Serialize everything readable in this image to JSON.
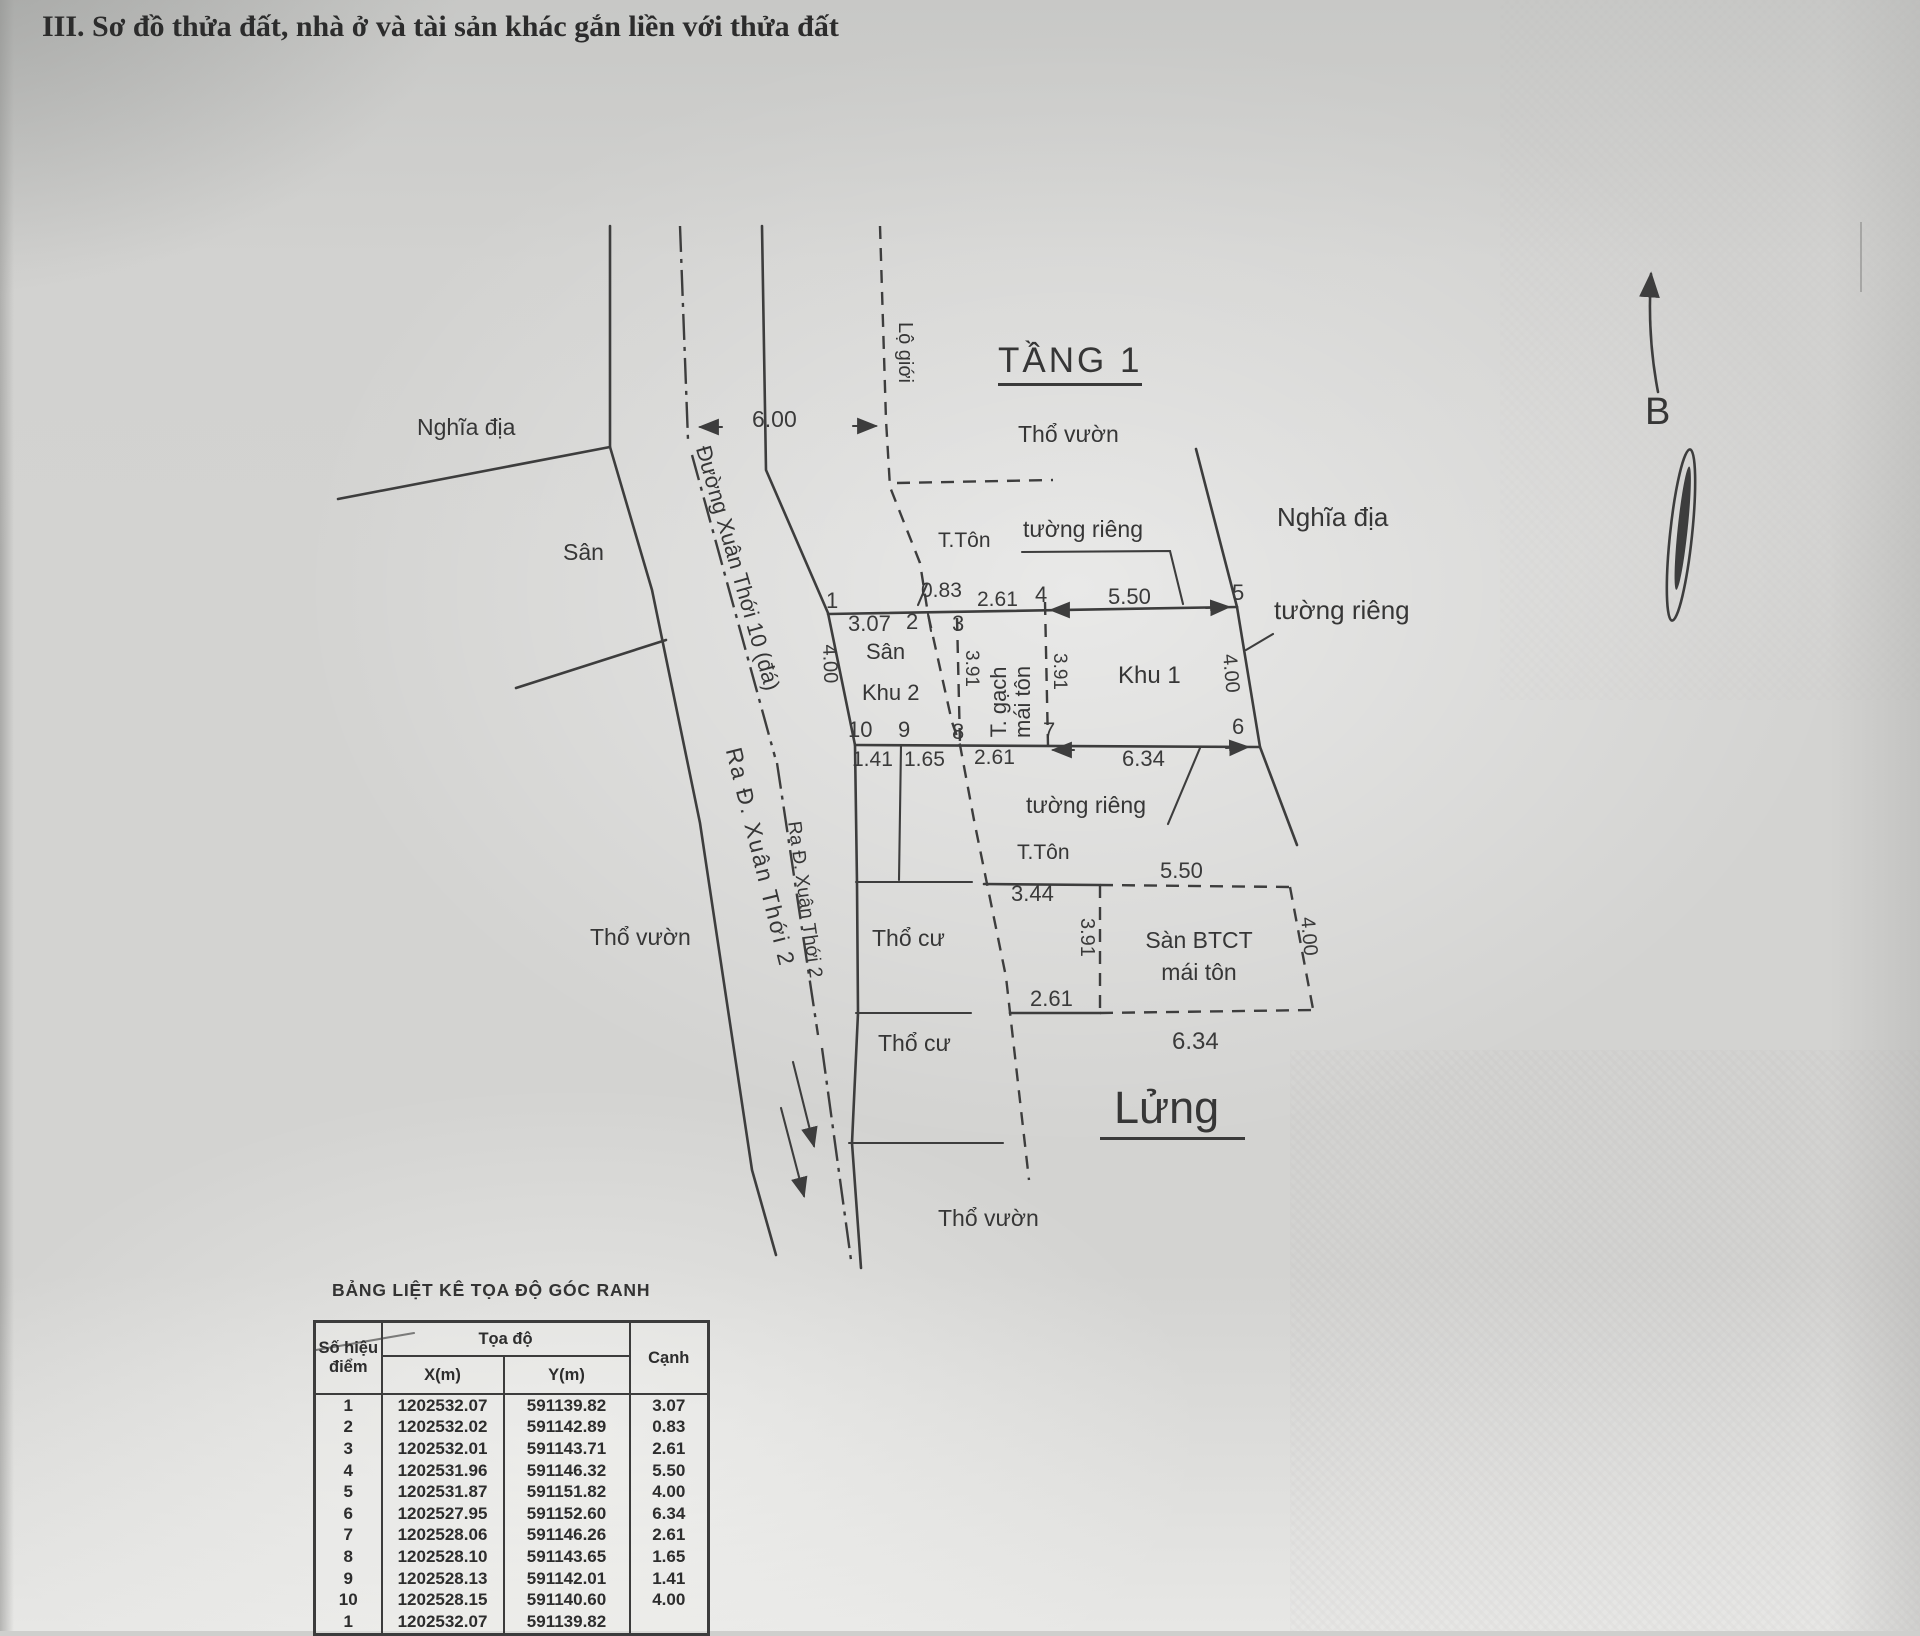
{
  "title": "III. Sơ đồ thửa đất, nhà ở và tài sản khác gắn liền với thửa đất",
  "plan": {
    "floor1_heading": "TẦNG 1",
    "mezzanine_heading": "Lửng",
    "north_label": "B",
    "road_name": "Đường Xuân Thới 10 (đá)",
    "road_exit_a": "Ra Đ. Xuân Thới 2",
    "road_exit_b": "Ra Đ. Xuân Thới 2",
    "setback_label": "Lộ giới",
    "labels": {
      "nghia_dia_left": "Nghĩa địa",
      "nghia_dia_right": "Nghĩa địa",
      "san_left": "Sân",
      "san_inner": "Sân",
      "khu2": "Khu 2",
      "khu1": "Khu 1",
      "tho_vuon_top": "Thổ vườn",
      "tho_vuon_left": "Thổ vườn",
      "tho_vuon_bottom": "Thổ vườn",
      "tho_cu_1": "Thổ cư",
      "tho_cu_2": "Thổ cư",
      "tuong_rieng_top": "tường riêng",
      "tuong_rieng_right": "tường riêng",
      "tuong_rieng_mid": "tường riêng",
      "t_ton_top": "T.Tôn",
      "t_ton_bottom": "T.Tôn",
      "t_gach_line1": "T. gạch",
      "t_gach_line2": "mái tôn",
      "san_btct_line1": "Sàn BTCT",
      "san_btct_line2": "mái tôn"
    },
    "dimensions": {
      "d600": "6.00",
      "d307": "3.07",
      "d083": "0.83",
      "d261_top": "2.61",
      "d550_top": "5.50",
      "d400_left": "4.00",
      "d400_right": "4.00",
      "d391_a": "3.91",
      "d391_b": "3.91",
      "d391_c": "3.91",
      "d141": "1.41",
      "d165": "1.65",
      "d261_mid": "2.61",
      "d634_top": "6.34",
      "d550_bottom": "5.50",
      "d344": "3.44",
      "d261_bottom": "2.61",
      "d634_bottom": "6.34",
      "d400_bottom": "4.00"
    },
    "points": {
      "p1": "1",
      "p2": "2",
      "p3": "3",
      "p4": "4",
      "p5": "5",
      "p6": "6",
      "p7": "7",
      "p8": "8",
      "p9": "9",
      "p10": "10"
    }
  },
  "table": {
    "title": "BẢNG LIỆT KÊ TỌA ĐỘ GÓC RANH",
    "header": {
      "point_line1": "Số hiệu",
      "point_line2": "điểm",
      "coord_group": "Tọa độ",
      "x": "X(m)",
      "y": "Y(m)",
      "edge": "Cạnh"
    },
    "rows": [
      {
        "p": "1",
        "x": "1202532.07",
        "y": "591139.82",
        "c": "3.07"
      },
      {
        "p": "2",
        "x": "1202532.02",
        "y": "591142.89",
        "c": "0.83"
      },
      {
        "p": "3",
        "x": "1202532.01",
        "y": "591143.71",
        "c": "2.61"
      },
      {
        "p": "4",
        "x": "1202531.96",
        "y": "591146.32",
        "c": "5.50"
      },
      {
        "p": "5",
        "x": "1202531.87",
        "y": "591151.82",
        "c": "4.00"
      },
      {
        "p": "6",
        "x": "1202527.95",
        "y": "591152.60",
        "c": "6.34"
      },
      {
        "p": "7",
        "x": "1202528.06",
        "y": "591146.26",
        "c": "2.61"
      },
      {
        "p": "8",
        "x": "1202528.10",
        "y": "591143.65",
        "c": "1.65"
      },
      {
        "p": "9",
        "x": "1202528.13",
        "y": "591142.01",
        "c": "1.41"
      },
      {
        "p": "10",
        "x": "1202528.15",
        "y": "591140.60",
        "c": "4.00"
      },
      {
        "p": "1",
        "x": "1202532.07",
        "y": "591139.82",
        "c": ""
      }
    ]
  }
}
